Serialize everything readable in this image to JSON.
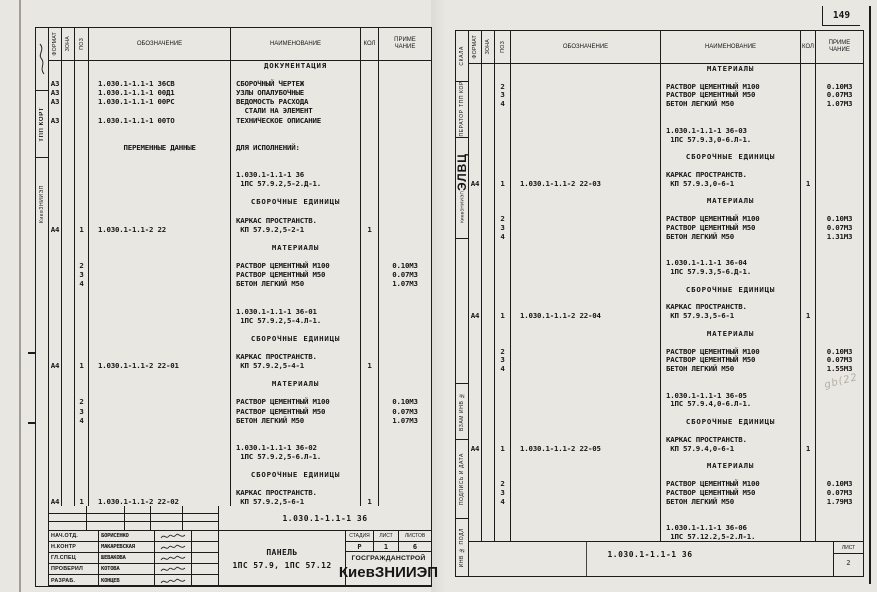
{
  "page": {
    "number": "149",
    "watermark": "gb(22"
  },
  "header": {
    "format": "ФОРМАТ",
    "zone": "ЗОНА",
    "pos": "ПОЗ",
    "designation": "ОБОЗНАЧЕНИЕ",
    "name": "НАИМЕНОВАНИЕ",
    "qty": "КОЛ",
    "note1": "ПРИМЕ",
    "note2": "ЧАНИЕ"
  },
  "left_sheet": {
    "margin": {
      "org": "КиевЗНИИЭП",
      "dept": "ТПП КОРТ"
    },
    "lines": [
      {
        "n": "ДОКУМЕНТАЦИЯ",
        "s": "c"
      },
      {},
      {
        "f": "А3",
        "d": "1.030.1-1.1-1 36СВ",
        "n": "СБОРОЧНЫЙ ЧЕРТЕЖ"
      },
      {
        "f": "А3",
        "d": "1.030.1-1.1-1 00Д1",
        "n": "УЗЛЫ ОПАЛУБОЧНЫЕ"
      },
      {
        "f": "А3",
        "d": "1.030.1-1.1-1 00РС",
        "n": "ВЕДОМОСТЬ РАСХОДА"
      },
      {
        "n": "  СТАЛИ НА ЭЛЕМЕНТ"
      },
      {
        "f": "А3",
        "d": "1.030.1-1.1-1 00ТО",
        "n": "ТЕХНИЧЕСКОЕ ОПИСАНИЕ"
      },
      {},
      {},
      {
        "d": "      ПЕРЕМЕННЫЕ ДАННЫЕ",
        "n": "ДЛЯ ИСПОЛНЕНИЙ:"
      },
      {},
      {},
      {
        "n": "1.030.1-1.1-1 36"
      },
      {
        "n": " 1ПС 57.9.2,5-2.Д-1."
      },
      {},
      {
        "n": "СБОРОЧНЫЕ ЕДИНИЦЫ",
        "s": "c"
      },
      {},
      {
        "n": "КАРКАС ПРОСТРАНСТВ."
      },
      {
        "f": "А4",
        "p": "1",
        "d": "1.030.1-1.1-2 22",
        "n": " КП 57.9.2,5-2-1",
        "q": "1"
      },
      {},
      {
        "n": "МАТЕРИАЛЫ",
        "s": "c"
      },
      {},
      {
        "p": "2",
        "n": "РАСТВОР ЦЕМЕНТНЫЙ М100",
        "r": "0.10М3"
      },
      {
        "p": "3",
        "n": "РАСТВОР ЦЕМЕНТНЫЙ М50",
        "r": "0.07М3"
      },
      {
        "p": "4",
        "n": "БЕТОН ЛЕГКИЙ М50",
        "r": "1.07М3"
      },
      {},
      {},
      {
        "n": "1.030.1-1.1-1 36-01"
      },
      {
        "n": " 1ПС 57.9.2,5-4.Л-1."
      },
      {},
      {
        "n": "СБОРОЧНЫЕ ЕДИНИЦЫ",
        "s": "c"
      },
      {},
      {
        "n": "КАРКАС ПРОСТРАНСТВ."
      },
      {
        "f": "А4",
        "p": "1",
        "d": "1.030.1-1.1-2 22-01",
        "n": " КП 57.9.2,5-4-1",
        "q": "1"
      },
      {},
      {
        "n": "МАТЕРИАЛЫ",
        "s": "c"
      },
      {},
      {
        "p": "2",
        "n": "РАСТВОР ЦЕМЕНТНЫЙ М100",
        "r": "0.10М3"
      },
      {
        "p": "3",
        "n": "РАСТВОР ЦЕМЕНТНЫЙ М50",
        "r": "0.07М3"
      },
      {
        "p": "4",
        "n": "БЕТОН ЛЕГКИЙ М50",
        "r": "1.07М3"
      },
      {},
      {},
      {
        "n": "1.030.1-1.1-1 36-02"
      },
      {
        "n": " 1ПС 57.9.2,5-6.Л-1."
      },
      {},
      {
        "n": "СБОРОЧНЫЕ ЕДИНИЦЫ",
        "s": "c"
      },
      {},
      {
        "n": "КАРКАС ПРОСТРАНСТВ."
      },
      {
        "f": "А4",
        "p": "1",
        "d": "1.030.1-1.1-2 22-02",
        "n": " КП 57.9.2,5-6-1",
        "q": "1"
      }
    ],
    "footer_doc": "1.030.1-1.1-1 36",
    "title_block": {
      "rows": [
        {
          "role": "НАЧ.ОТД.",
          "name": "БОРИСЕНКО"
        },
        {
          "role": "Н.КОНТР",
          "name": "МАКАРЕВСКАЯ"
        },
        {
          "role": "ГЛ.СПЕЦ",
          "name": "ШЕВАКОВА"
        },
        {
          "role": "ПРОВЕРИЛ",
          "name": "КОТОВА"
        },
        {
          "role": "РАЗРАБ.",
          "name": "КОНЦЕВ"
        }
      ],
      "subject1": "ПАНЕЛЬ",
      "subject2": "1ПС 57.9, 1ПС 57.12",
      "stage_label": "СТАДИЯ",
      "sheet_label": "ЛИСТ",
      "sheets_label": "ЛИСТОВ",
      "stage": "Р",
      "sheet": "1",
      "sheets": "6",
      "org1": "ГОСГРАЖДАНСТРОЙ",
      "org2": "КиевЗНИИЭП"
    }
  },
  "right_sheet": {
    "margin": {
      "name": "СКАЛА",
      "operator_label": "ОПЕРАТОР",
      "operator_value": "ТПП КОРТ",
      "evc_big": "ЭЛВЦ",
      "evc_small": "КиевЗНИИЭП",
      "stamps": [
        "ВЗАМ ИНВ №",
        "ПОДПИСЬ И ДАТА",
        "ИНВ № ПОДЛ"
      ]
    },
    "lines": [
      {
        "n": "МАТЕРИАЛЫ",
        "s": "c"
      },
      {},
      {
        "p": "2",
        "n": "РАСТВОР ЦЕМЕНТНЫЙ М100",
        "r": "0.10М3"
      },
      {
        "p": "3",
        "n": "РАСТВОР ЦЕМЕНТНЫЙ М50",
        "r": "0.07М3"
      },
      {
        "p": "4",
        "n": "БЕТОН ЛЕГКИЙ М50",
        "r": "1.07М3"
      },
      {},
      {},
      {
        "n": "1.030.1-1.1-1 36-03"
      },
      {
        "n": " 1ПС 57.9.3,0-6.Л-1."
      },
      {},
      {
        "n": "СБОРОЧНЫЕ ЕДИНИЦЫ",
        "s": "c"
      },
      {},
      {
        "n": "КАРКАС ПРОСТРАНСТВ."
      },
      {
        "f": "А4",
        "p": "1",
        "d": "1.030.1-1.1-2 22-03",
        "n": " КП 57.9.3,0-6-1",
        "q": "1"
      },
      {},
      {
        "n": "МАТЕРИАЛЫ",
        "s": "c"
      },
      {},
      {
        "p": "2",
        "n": "РАСТВОР ЦЕМЕНТНЫЙ М100",
        "r": "0.10М3"
      },
      {
        "p": "3",
        "n": "РАСТВОР ЦЕМЕНТНЫЙ М50",
        "r": "0.07М3"
      },
      {
        "p": "4",
        "n": "БЕТОН ЛЕГКИЙ М50",
        "r": "1.31М3"
      },
      {},
      {},
      {
        "n": "1.030.1-1.1-1 36-04"
      },
      {
        "n": " 1ПС 57.9.3,5-6.Д-1."
      },
      {},
      {
        "n": "СБОРОЧНЫЕ ЕДИНИЦЫ",
        "s": "c"
      },
      {},
      {
        "n": "КАРКАС ПРОСТРАНСТВ."
      },
      {
        "f": "А4",
        "p": "1",
        "d": "1.030.1-1.1-2 22-04",
        "n": " КП 57.9.3,5-6-1",
        "q": "1"
      },
      {},
      {
        "n": "МАТЕРИАЛЫ",
        "s": "c"
      },
      {},
      {
        "p": "2",
        "n": "РАСТВОР ЦЕМЕНТНЫЙ М100",
        "r": "0.10М3"
      },
      {
        "p": "3",
        "n": "РАСТВОР ЦЕМЕНТНЫЙ М50",
        "r": "0.07М3"
      },
      {
        "p": "4",
        "n": "БЕТОН ЛЕГКИЙ М50",
        "r": "1.55М3"
      },
      {},
      {},
      {
        "n": "1.030.1-1.1-1 36-05"
      },
      {
        "n": " 1ПС 57.9.4,0-6.Л-1."
      },
      {},
      {
        "n": "СБОРОЧНЫЕ ЕДИНИЦЫ",
        "s": "c"
      },
      {},
      {
        "n": "КАРКАС ПРОСТРАНСТВ."
      },
      {
        "f": "А4",
        "p": "1",
        "d": "1.030.1-1.1-2 22-05",
        "n": " КП 57.9.4,0-6-1",
        "q": "1"
      },
      {},
      {
        "n": "МАТЕРИАЛЫ",
        "s": "c"
      },
      {},
      {
        "p": "2",
        "n": "РАСТВОР ЦЕМЕНТНЫЙ М100",
        "r": "0.10М3"
      },
      {
        "p": "3",
        "n": "РАСТВОР ЦЕМЕНТНЫЙ М50",
        "r": "0.07М3"
      },
      {
        "p": "4",
        "n": "БЕТОН ЛЕГКИЙ М50",
        "r": "1.79М3"
      },
      {},
      {},
      {
        "n": "1.030.1-1.1-1 36-06"
      },
      {
        "n": " 1ПС 57.12.2,5-2.Л-1."
      }
    ],
    "footer_doc": "1.030.1-1.1-1 36",
    "sheet_box": {
      "label": "ЛИСТ",
      "value": "2"
    }
  }
}
